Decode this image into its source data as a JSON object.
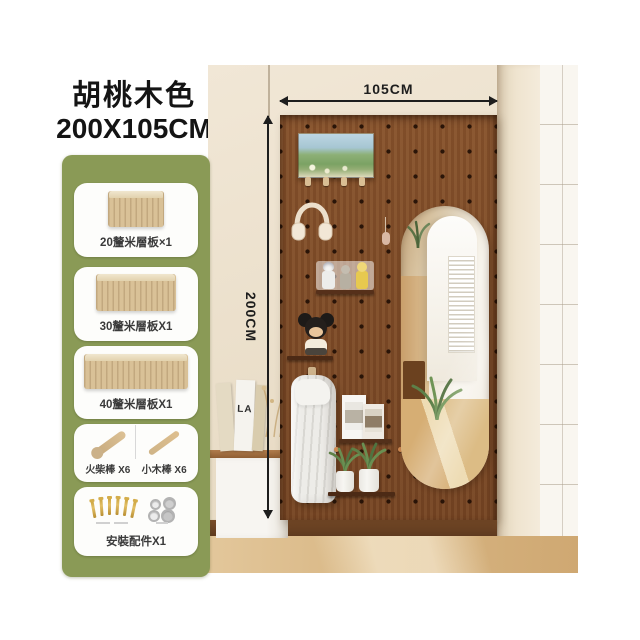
{
  "product": {
    "color_name": "胡桃木色",
    "size": "200X105CM"
  },
  "dimensions": {
    "width_label": "105CM",
    "height_label": "200CM"
  },
  "parts_panel": {
    "background_color": "#8a9a56",
    "items": [
      {
        "icon": "shelf-board-20cm-icon",
        "label": "20釐米層板×1"
      },
      {
        "icon": "shelf-board-30cm-icon",
        "label": "30釐米層板X1"
      },
      {
        "icon": "shelf-board-40cm-icon",
        "label": "40釐米層板X1"
      },
      {
        "icon": "wood-sticks-icon",
        "label_left": "火柴棒 X6",
        "label_right": "小木棒 X6"
      },
      {
        "icon": "mounting-hardware-icon",
        "label": "安裝配件X1"
      }
    ]
  },
  "scene": {
    "wall_color": "#ece0cb",
    "pegboard_color": "#7c4a26",
    "floor_color": "#d8b987",
    "dimension_line_color": "#1d1d1d",
    "book_text": "LA",
    "decor_items": [
      "landscape-painting",
      "headphones",
      "mini-figurines",
      "mickey-plush",
      "hanging-towel",
      "photo-frames",
      "potted-plants",
      "oval-mirror",
      "floating-cabinet",
      "books",
      "dried-flowers"
    ]
  }
}
